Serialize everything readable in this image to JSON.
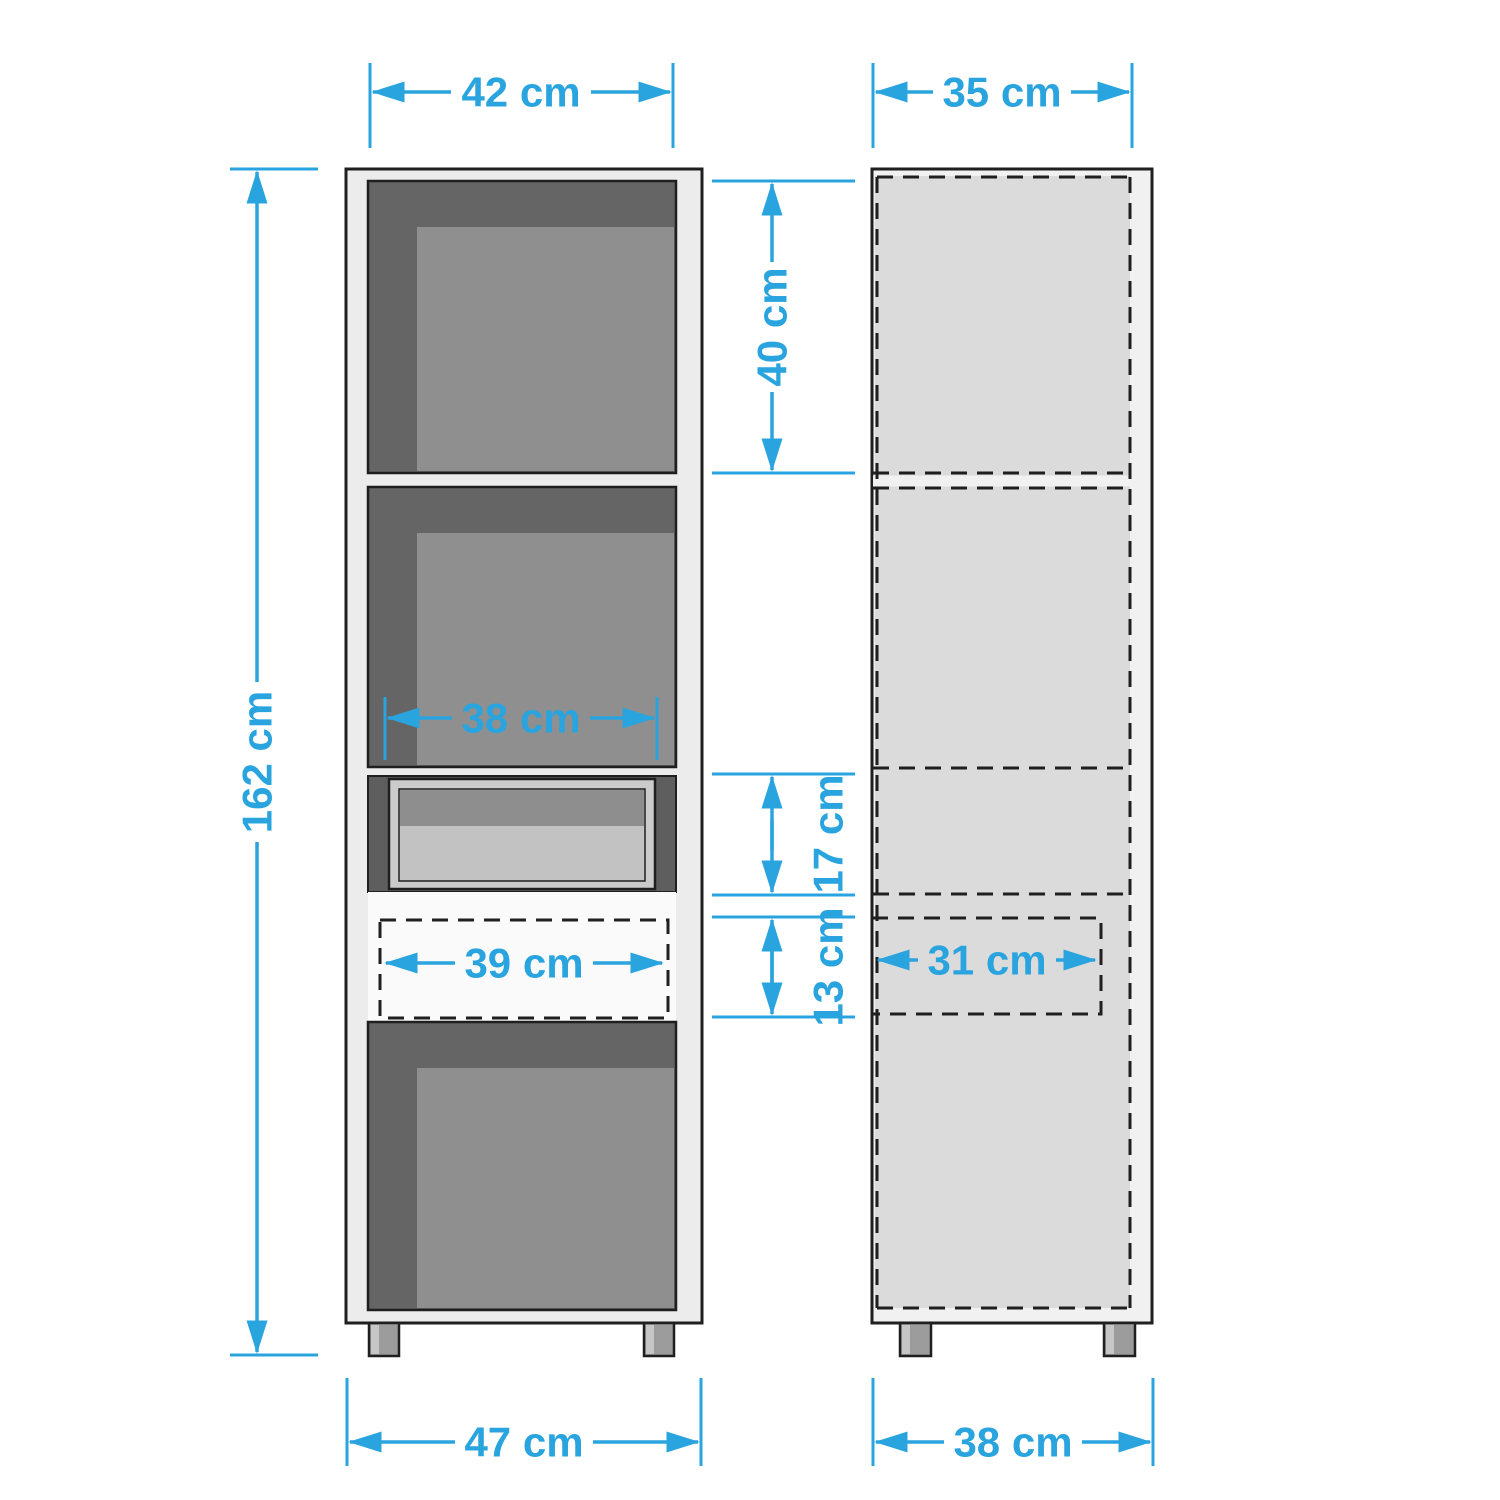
{
  "diagram": "cabinet-dimension-drawing",
  "unit": "cm",
  "colors": {
    "accent": "#2aa4de",
    "outline": "#1f1f1f",
    "frame": "#ececec",
    "side_body": "#f0f1f0",
    "compartment_dark": "#656565",
    "back_panel": "#8f8f8f",
    "side_panel": "#dbdbdb",
    "drawer_fill": "#e7e7e7"
  },
  "front_view": {
    "label": "front view",
    "dims": {
      "overall_width_top": "42 cm",
      "overall_height": "162 cm",
      "top_compartment_height": "40 cm",
      "compartment_inner_width": "38 cm",
      "niche_height": "17 cm",
      "drawer_height": "13 cm",
      "drawer_width": "39 cm",
      "base_width": "47 cm"
    }
  },
  "side_view": {
    "label": "side view",
    "dims": {
      "depth_top": "35 cm",
      "drawer_depth": "31 cm",
      "base_depth": "38 cm"
    }
  }
}
